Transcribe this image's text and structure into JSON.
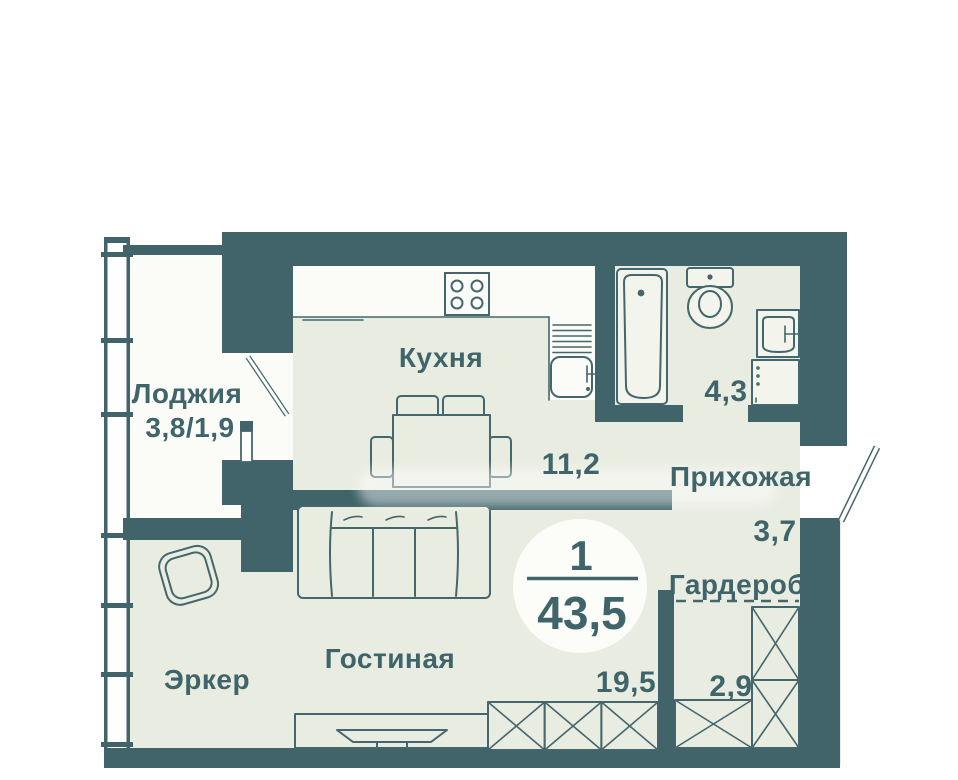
{
  "unit": {
    "rooms_count": "1",
    "total_area": "43,5"
  },
  "rooms": {
    "loggia": {
      "label": "Лоджия",
      "area": "3,8/1,9"
    },
    "kitchen": {
      "label": "Кухня",
      "area": "11,2"
    },
    "bathroom": {
      "area": "4,3"
    },
    "hallway": {
      "label": "Прихожая",
      "area": "3,7"
    },
    "wardrobe": {
      "label": "Гардероб",
      "area": "2,9"
    },
    "living_room": {
      "label": "Гостиная",
      "area": "19,5"
    },
    "bay_window": {
      "label": "Эркер"
    }
  },
  "colors": {
    "wall": "#40646a",
    "floor": "#e9ece0",
    "loggia_floor": "#fbfbf7",
    "background": "#ffffff",
    "line": "#44676d",
    "text": "#3f656b",
    "fixture": "#f3f4ec",
    "badge": "#fcfcf8"
  }
}
